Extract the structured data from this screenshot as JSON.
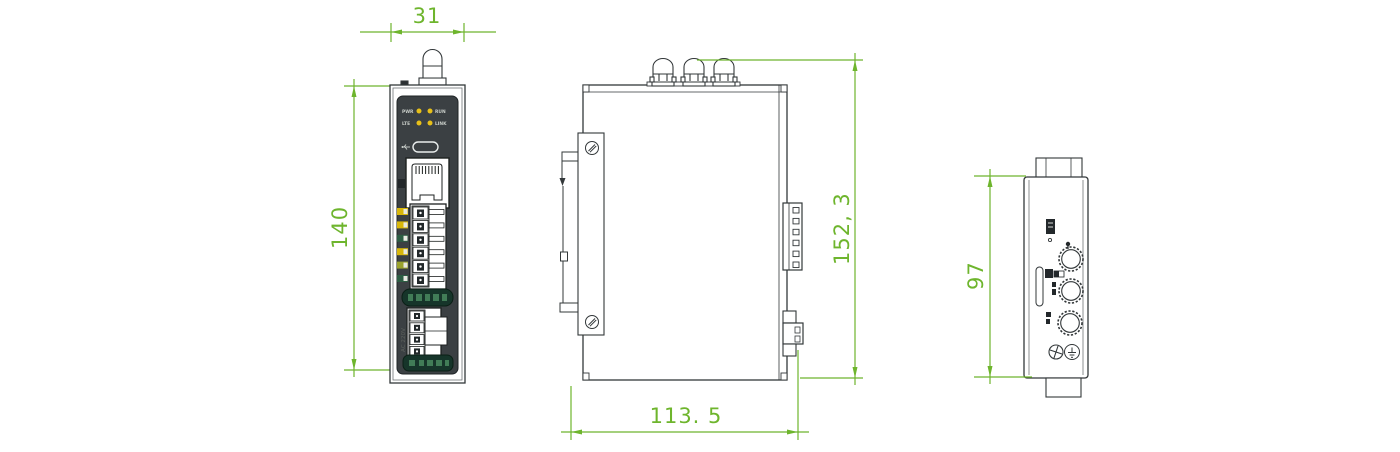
{
  "drawing": {
    "dimensions": {
      "front_width": "31",
      "front_height": "140",
      "side_height": "152, 3",
      "side_width": "113. 5",
      "right_height": "97"
    },
    "front_panel": {
      "leds": [
        {
          "label": "PWR"
        },
        {
          "label": "RUN"
        },
        {
          "label": "LTE"
        },
        {
          "label": "LINK"
        }
      ],
      "power_label": "AC 220V"
    },
    "colors": {
      "dimension_green": "#6eb52d",
      "line_dark": "#33383a",
      "panel_dark": "#3b4043",
      "led_yellow": "#e8c019",
      "label_green": "#16352a"
    },
    "icons": {
      "antenna-connector-icon": "dome cylinder shape",
      "usb-icon": "usb trident",
      "rj45-port-icon": "ethernet jack outline",
      "terminal-block-icon": "screw terminal cells",
      "din-rail-clip-icon": "mounting clip profile",
      "screw-icon": "slotted screw head",
      "sma-connector-icon": "knurled circle",
      "sim-slot-icon": "vertical slot",
      "ground-icon": "circle with cross",
      "earth-icon": "circle with earth symbol"
    }
  }
}
